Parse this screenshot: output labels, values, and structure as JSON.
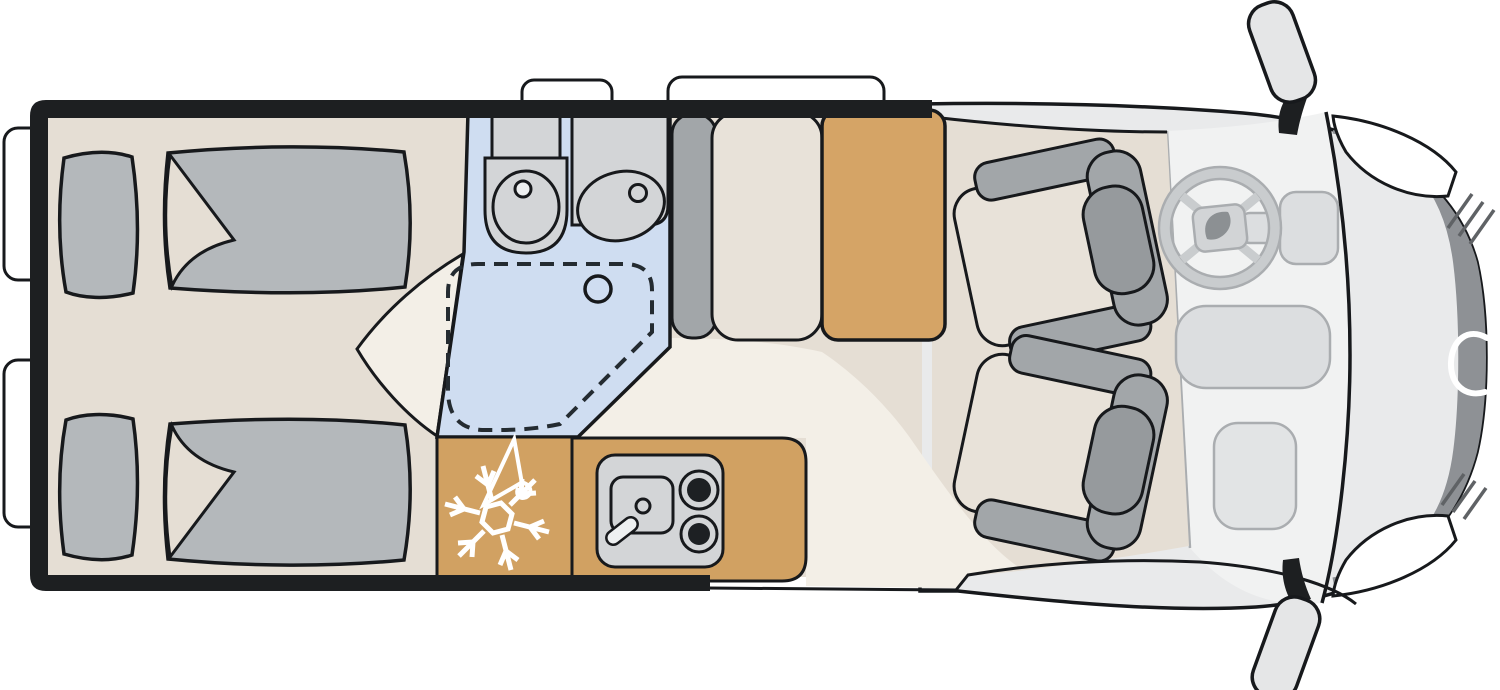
{
  "colors": {
    "background": "#ffffff",
    "wall": "#1d1f21",
    "outline": "#17191c",
    "floor": "#e5ded4",
    "walkway": "#f3efe7",
    "bathroom_floor": "#cfddf1",
    "fixture_gray": "#d3d5d7",
    "faucet_white": "#eef0f1",
    "kitchen_wood": "#d1a162",
    "table_wood": "#d5a466",
    "bedding_gray": "#b4b8bb",
    "upholstery_gray": "#a2a6a9",
    "headrest_gray": "#969a9d",
    "seat_cushion": "#e8e2d9",
    "cab_body": "#e9eaeb",
    "windshield_area": "#f1f2f2",
    "hood_dark": "#8e9195",
    "detail_line": "#aaadb0",
    "spoke_gray": "#c9ccce",
    "dash_fill": "#dcdee0",
    "glovebox_fill": "#e2e4e5",
    "hub_fill": "#d2d4d6",
    "logo_gray": "#8c9093",
    "mirror_fill": "#e5e6e7",
    "window_white": "#ffffff",
    "icon_white": "#ffffff",
    "burner_black": "#1d2023",
    "hatch_dark": "#5f6265"
  },
  "floorplan": {
    "vehicle": "camper-van-top-view",
    "areas": [
      {
        "name": "rear-bedroom",
        "features": [
          "single-bed-top",
          "single-bed-bottom",
          "pillow",
          "folded-duvet"
        ]
      },
      {
        "name": "bathroom",
        "features": [
          "washbasin",
          "toilet",
          "shower-dashed-outline",
          "shower-drain"
        ]
      },
      {
        "name": "wardrobe-fridge",
        "features": [
          "snowflake-icon",
          "hanger-icon"
        ]
      },
      {
        "name": "kitchen",
        "features": [
          "sink",
          "faucet",
          "two-burner-hob"
        ]
      },
      {
        "name": "dinette",
        "features": [
          "bench-backrest",
          "bench-seat",
          "table"
        ]
      },
      {
        "name": "cab",
        "features": [
          "driver-seat-swiveled",
          "passenger-seat-swiveled",
          "steering-wheel",
          "center-console",
          "glovebox",
          "windshield",
          "hood",
          "side-mirror-top",
          "side-mirror-bottom",
          "entry-step"
        ]
      }
    ],
    "icons": [
      "snowflake-icon",
      "hanger-icon",
      "steering-wheel-icon",
      "brand-logo-swoosh"
    ],
    "windows": {
      "rear_left_wall": 2,
      "top_wall": 2
    }
  }
}
